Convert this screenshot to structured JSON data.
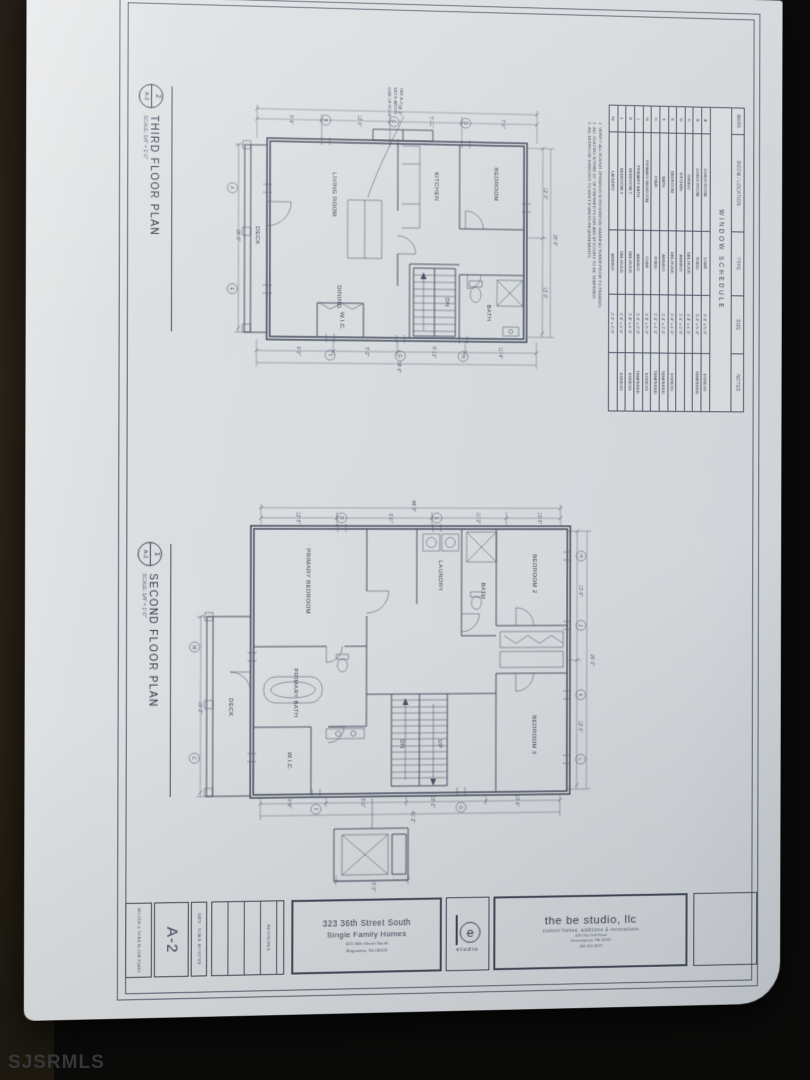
{
  "watermark": "SJSRMLS",
  "labels": {
    "third": {
      "num": "2",
      "sheet": "A-2",
      "title": "THIRD FLOOR PLAN",
      "scale": "SCALE: 1/4\" = 1'-0\""
    },
    "second": {
      "num": "1",
      "sheet": "A-2",
      "title": "SECOND FLOOR PLAN",
      "scale": "SCALE: 1/4\" = 1'-0\""
    }
  },
  "schedule": {
    "title": "WINDOW SCHEDULE",
    "headers": [
      "MARK",
      "ROOM / LOCATION",
      "TYPE",
      "SIZE",
      "NOTES"
    ],
    "rows": [
      {
        "mark": "A",
        "room": "LIVING ROOM",
        "type": "CSMT",
        "size": "3'-0\" x 5'-0\"",
        "notes": "EGRESS"
      },
      {
        "mark": "B",
        "room": "LIVING ROOM",
        "type": "FIXED",
        "size": "3'-0\" x 5'-0\"",
        "notes": "TEMPERED"
      },
      {
        "mark": "C",
        "room": "DINING",
        "type": "DBL HUNG",
        "size": "2'-8\" x 4'-6\"",
        "notes": ""
      },
      {
        "mark": "D",
        "room": "KITCHEN",
        "type": "AWNING",
        "size": "2'-6\" x 2'-0\"",
        "notes": ""
      },
      {
        "mark": "E",
        "room": "BEDROOM",
        "type": "DBL HUNG",
        "size": "2'-8\" x 4'-6\"",
        "notes": "EGRESS"
      },
      {
        "mark": "F",
        "room": "BATH",
        "type": "AWNING",
        "size": "2'-0\" x 2'-0\"",
        "notes": "TEMPERED"
      },
      {
        "mark": "G",
        "room": "STAIR",
        "type": "FIXED",
        "size": "2'-0\" x 4'-0\"",
        "notes": "TEMPERED"
      },
      {
        "mark": "H",
        "room": "PRIMARY BEDROOM",
        "type": "CSMT",
        "size": "2'-8\" x 5'-0\"",
        "notes": "EGRESS"
      },
      {
        "mark": "J",
        "room": "PRIMARY BATH",
        "type": "AWNING",
        "size": "2'-0\" x 2'-0\"",
        "notes": "TEMPERED"
      },
      {
        "mark": "K",
        "room": "BEDROOM 2",
        "type": "DBL HUNG",
        "size": "2'-8\" x 4'-6\"",
        "notes": "EGRESS"
      },
      {
        "mark": "L",
        "room": "BEDROOM 3",
        "type": "DBL HUNG",
        "size": "2'-8\" x 4'-6\"",
        "notes": "EGRESS"
      },
      {
        "mark": "M",
        "room": "LAUNDRY",
        "type": "AWNING",
        "size": "2'-0\" x 2'-0\"",
        "notes": ""
      }
    ],
    "notes": [
      "1. VERIFY ALL ROUGH OPENINGS WITH WINDOW MANUFACTURER PRIOR TO FRAMING.",
      "2. ALL GLAZING WITHIN 18\" OF FINISHED FLOOR AND AT DOORS TO BE TEMPERED.",
      "3. ALL BEDROOM WINDOWS TO MEET EGRESS REQUIREMENTS."
    ]
  },
  "titleblock": {
    "sheet_name": "SECOND & THIRD FLOOR PLANS",
    "sheet_number": "A-2",
    "meta": "DATE · SCALE: AS NOTED",
    "revisions": "REVISIONS",
    "project": {
      "line1": "323 36th Street South",
      "line2": "Single Family Homes",
      "addr1": "323 36th Street South",
      "addr2": "Brigantine, NJ 08203"
    },
    "logo": {
      "mark": "e",
      "word": "studio"
    },
    "firm": {
      "name": "the be studio, llc",
      "tagline": "custom homes, additions & renovations",
      "addr1": "403 Otto Dell Road",
      "addr2": "Downingtown, PA 19335",
      "phone": "484.452.6879"
    }
  },
  "plans": {
    "third": {
      "annotation": [
        "LINE OF ROOF",
        "DECK ABOVE",
        "SEE A-4"
      ],
      "rooms": [
        "LIVING ROOM",
        "DINING",
        "KITCHEN",
        "BEDROOM",
        "BATH",
        "W.I.C.",
        "DECK",
        "DN"
      ],
      "dims": [
        "8'-4\"",
        "12'-6\"",
        "5'-11\"",
        "7'-9\"",
        "34'-6\"",
        "9'-2\"",
        "5'-2\"",
        "8'-10\"",
        "11'-4\"",
        "34'-6\"",
        "12'-0\"",
        "13'-0\"",
        "25'-0\"",
        "25'-0\""
      ],
      "marks": [
        "B",
        "C",
        "D",
        "A",
        "E",
        "F",
        "G",
        "H"
      ]
    },
    "second": {
      "rooms": [
        "PRIMARY BEDROOM",
        "LAUNDRY",
        "BATH",
        "BEDROOM 2",
        "BEDROOM 3",
        "PRIMARY BATH",
        "W.I.C.",
        "DECK",
        "UP",
        "DN"
      ],
      "dims": [
        "12'-8\"",
        "9'-6\"",
        "11'-2\"",
        "10'-8\"",
        "44'-0\"",
        "6'-4\"",
        "5'-0\"",
        "16'-2\"",
        "13'-6\"",
        "41'-2\"",
        "13'-6\"",
        "12'-6\"",
        "26'-0\"",
        "16'-2\"",
        "6'-0\""
      ],
      "marks": [
        "D",
        "E",
        "H",
        "J",
        "K",
        "L",
        "M",
        "C",
        "F",
        "G"
      ]
    }
  }
}
